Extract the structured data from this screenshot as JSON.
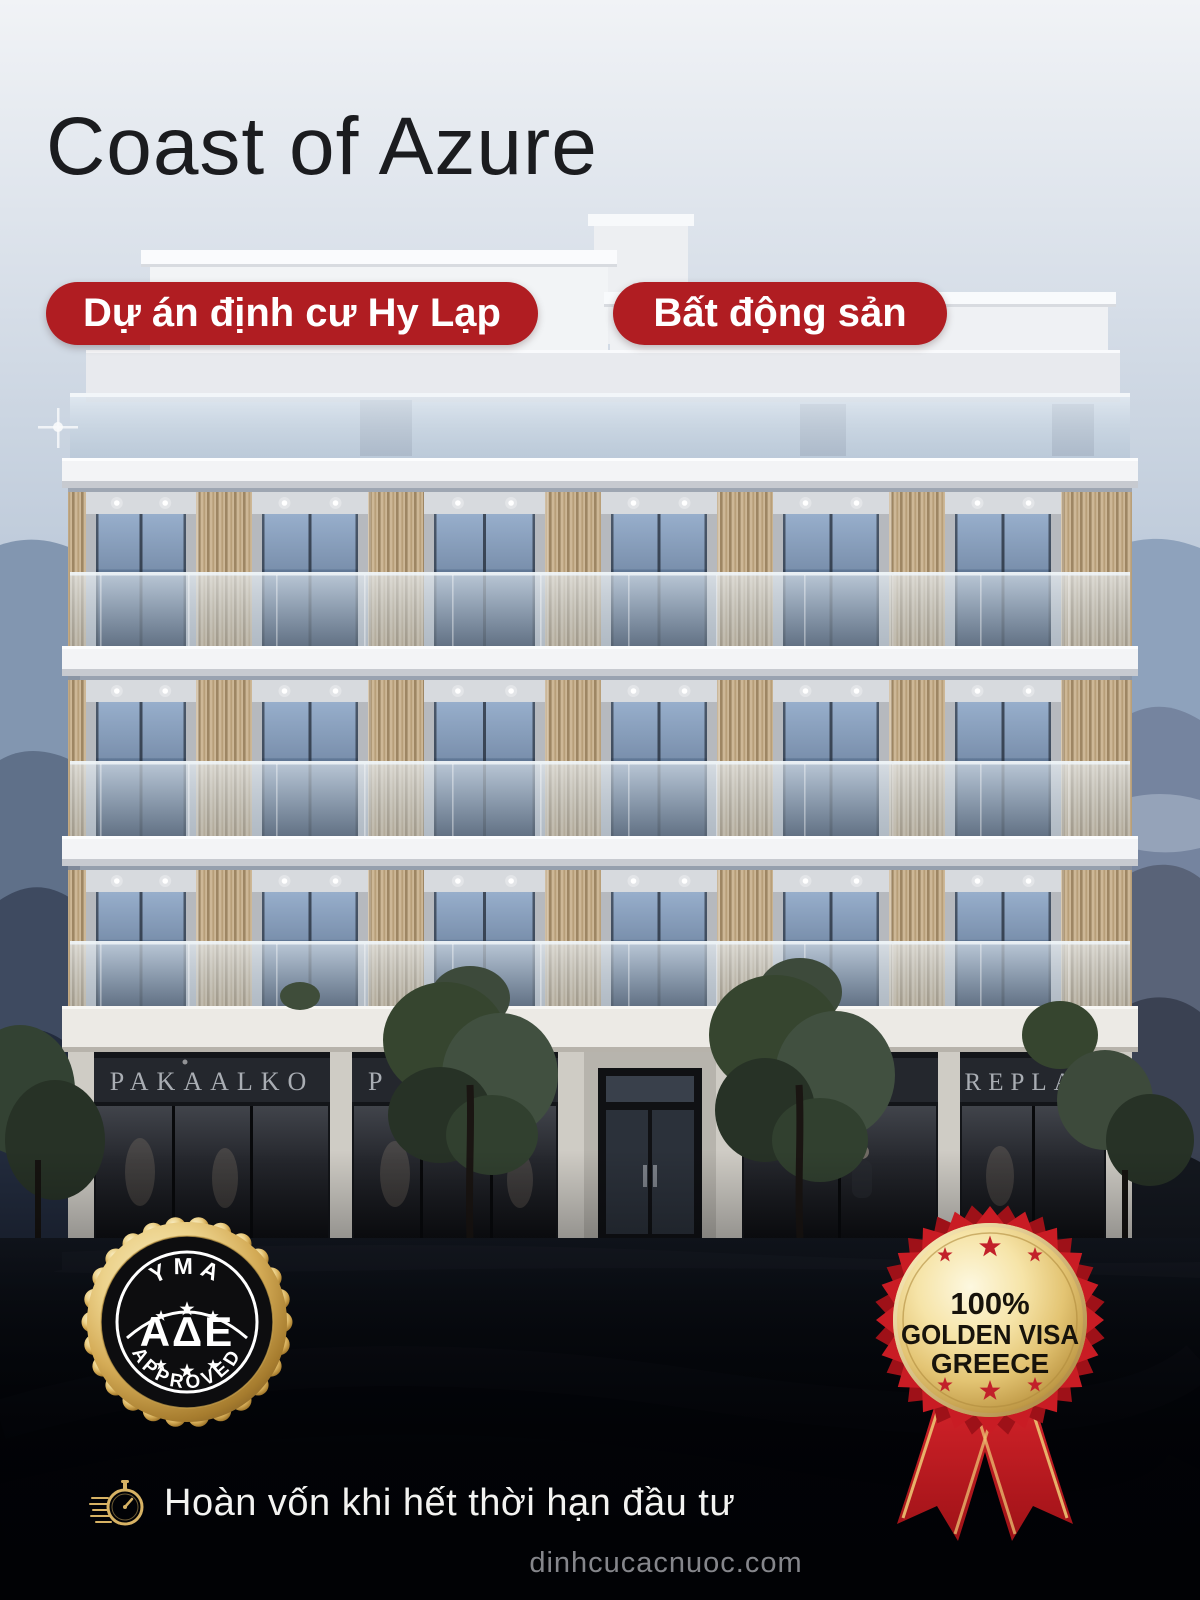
{
  "header": {
    "title": "Coast of Azure",
    "badges": [
      {
        "label": "Dự án định cư Hy Lạp"
      },
      {
        "label": "Bất động sản"
      }
    ]
  },
  "building": {
    "storefront_signs": [
      "PAKAALKO",
      "P A K A",
      "AY",
      "REPLAY"
    ]
  },
  "approval_seal": {
    "top_text": "YMA",
    "center_text": "ΑΔΕ",
    "bottom_text": "APPROVED"
  },
  "award_badge": {
    "line1": "100%",
    "line2": "GOLDEN VISA",
    "line3": "GREECE"
  },
  "footer": {
    "tagline": "Hoàn vốn khi hết thời hạn đầu tư",
    "website": "dinhcucacnuoc.com"
  },
  "colors": {
    "pill_red": "#b01d22",
    "award_red": "#c91c24",
    "gold": "#d9b25f",
    "title_black": "#1b1c1f",
    "sky_top": "#f1f3f6"
  }
}
